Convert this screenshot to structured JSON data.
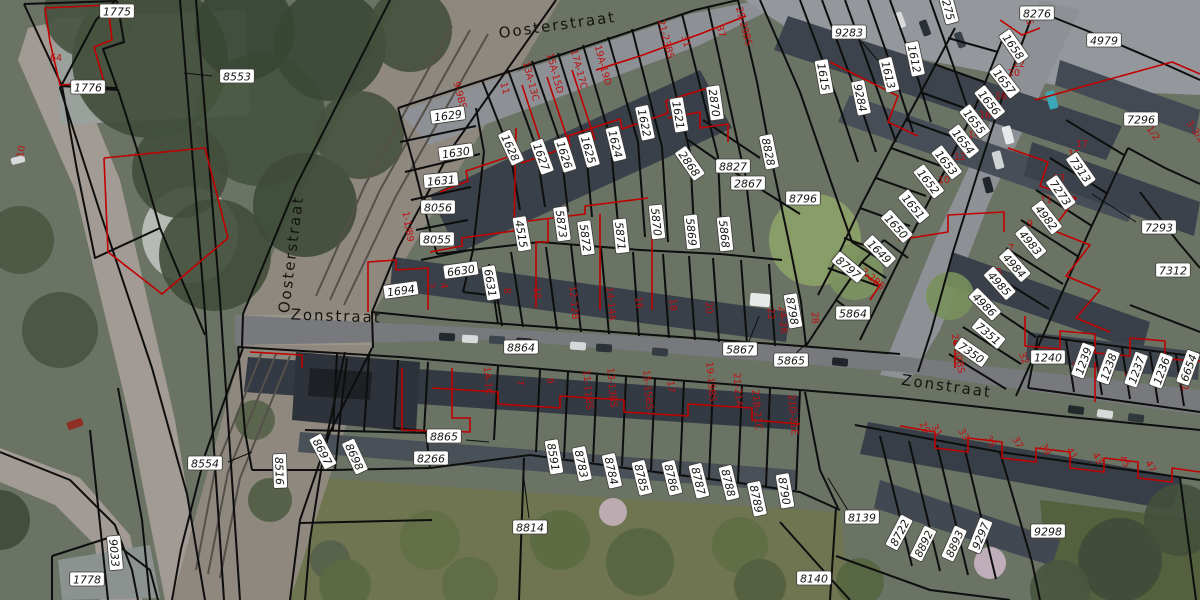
{
  "map": {
    "colors": {
      "parcel_line": "#0e0e0e",
      "building_line": "#c00000",
      "parcel_label_bg": "#ffffff",
      "parcel_label_border": "#3c3c38",
      "parcel_label_text": "#161612",
      "house_number_text": "#c01010",
      "street_text": "#14140f"
    },
    "street_labels": [
      {
        "text": "Oosterstraat",
        "x": 558,
        "y": 30,
        "rot": -8
      },
      {
        "text": "Oosterstraat",
        "x": 296,
        "y": 255,
        "rot": -83
      },
      {
        "text": "Zonstraat",
        "x": 336,
        "y": 321,
        "rot": 2
      },
      {
        "text": "Zonstraat",
        "x": 946,
        "y": 391,
        "rot": 8
      }
    ],
    "parcel_labels": [
      {
        "text": "1775",
        "x": 117,
        "y": 12,
        "rot": 0
      },
      {
        "text": "1776",
        "x": 88,
        "y": 88,
        "rot": 0
      },
      {
        "text": "8553",
        "x": 237,
        "y": 77,
        "rot": 0
      },
      {
        "text": "1629",
        "x": 448,
        "y": 116,
        "rot": -8
      },
      {
        "text": "1630",
        "x": 456,
        "y": 153,
        "rot": -8
      },
      {
        "text": "1631",
        "x": 441,
        "y": 181,
        "rot": -5
      },
      {
        "text": "8056",
        "x": 438,
        "y": 208,
        "rot": 0
      },
      {
        "text": "8055",
        "x": 437,
        "y": 240,
        "rot": 0
      },
      {
        "text": "6630",
        "x": 461,
        "y": 271,
        "rot": -8
      },
      {
        "text": "1694",
        "x": 401,
        "y": 291,
        "rot": -8
      },
      {
        "text": "6631",
        "x": 490,
        "y": 283,
        "rot": 80
      },
      {
        "text": "4515",
        "x": 521,
        "y": 234,
        "rot": 80
      },
      {
        "text": "5873",
        "x": 561,
        "y": 224,
        "rot": 82
      },
      {
        "text": "5872",
        "x": 585,
        "y": 238,
        "rot": 82
      },
      {
        "text": "5871",
        "x": 620,
        "y": 236,
        "rot": 84
      },
      {
        "text": "5870",
        "x": 656,
        "y": 222,
        "rot": 84
      },
      {
        "text": "5869",
        "x": 691,
        "y": 232,
        "rot": 84
      },
      {
        "text": "5868",
        "x": 724,
        "y": 234,
        "rot": 84
      },
      {
        "text": "1628",
        "x": 510,
        "y": 148,
        "rot": 65
      },
      {
        "text": "1627",
        "x": 541,
        "y": 157,
        "rot": 70
      },
      {
        "text": "1626",
        "x": 564,
        "y": 155,
        "rot": 72
      },
      {
        "text": "1625",
        "x": 588,
        "y": 150,
        "rot": 74
      },
      {
        "text": "1624",
        "x": 615,
        "y": 144,
        "rot": 76
      },
      {
        "text": "1622",
        "x": 644,
        "y": 123,
        "rot": 78
      },
      {
        "text": "1621",
        "x": 678,
        "y": 115,
        "rot": 80
      },
      {
        "text": "2870",
        "x": 714,
        "y": 103,
        "rot": 82
      },
      {
        "text": "2868",
        "x": 689,
        "y": 164,
        "rot": 55
      },
      {
        "text": "8827",
        "x": 733,
        "y": 167,
        "rot": 0
      },
      {
        "text": "2867",
        "x": 748,
        "y": 184,
        "rot": 0
      },
      {
        "text": "8828",
        "x": 768,
        "y": 152,
        "rot": 78
      },
      {
        "text": "8796",
        "x": 803,
        "y": 199,
        "rot": 0
      },
      {
        "text": "1658",
        "x": 1013,
        "y": 47,
        "rot": 55
      },
      {
        "text": "1657",
        "x": 1004,
        "y": 82,
        "rot": 52
      },
      {
        "text": "1656",
        "x": 989,
        "y": 103,
        "rot": 52
      },
      {
        "text": "1655",
        "x": 974,
        "y": 122,
        "rot": 52
      },
      {
        "text": "1654",
        "x": 963,
        "y": 142,
        "rot": 52
      },
      {
        "text": "1653",
        "x": 946,
        "y": 163,
        "rot": 52
      },
      {
        "text": "1652",
        "x": 928,
        "y": 182,
        "rot": 52
      },
      {
        "text": "1651",
        "x": 913,
        "y": 207,
        "rot": 50
      },
      {
        "text": "1650",
        "x": 896,
        "y": 227,
        "rot": 48
      },
      {
        "text": "1649",
        "x": 879,
        "y": 252,
        "rot": 45
      },
      {
        "text": "8797",
        "x": 848,
        "y": 268,
        "rot": 40
      },
      {
        "text": "8798",
        "x": 792,
        "y": 311,
        "rot": 80
      },
      {
        "text": "5864",
        "x": 853,
        "y": 314,
        "rot": 0
      },
      {
        "text": "5867",
        "x": 740,
        "y": 350,
        "rot": 0
      },
      {
        "text": "5865",
        "x": 791,
        "y": 361,
        "rot": 0
      },
      {
        "text": "9283",
        "x": 849,
        "y": 33,
        "rot": 0
      },
      {
        "text": "1612",
        "x": 914,
        "y": 59,
        "rot": 78
      },
      {
        "text": "1613",
        "x": 888,
        "y": 75,
        "rot": 76
      },
      {
        "text": "1615",
        "x": 823,
        "y": 77,
        "rot": 80
      },
      {
        "text": "9284",
        "x": 860,
        "y": 98,
        "rot": 78
      },
      {
        "text": "275",
        "x": 948,
        "y": 10,
        "rot": 75
      },
      {
        "text": "8276",
        "x": 1037,
        "y": 14,
        "rot": 0
      },
      {
        "text": "4979",
        "x": 1104,
        "y": 41,
        "rot": 0
      },
      {
        "text": "7296",
        "x": 1141,
        "y": 120,
        "rot": 0
      },
      {
        "text": "7313",
        "x": 1080,
        "y": 170,
        "rot": 55
      },
      {
        "text": "7273",
        "x": 1060,
        "y": 193,
        "rot": 55
      },
      {
        "text": "4982",
        "x": 1046,
        "y": 218,
        "rot": 52
      },
      {
        "text": "4983",
        "x": 1030,
        "y": 243,
        "rot": 50
      },
      {
        "text": "4984",
        "x": 1014,
        "y": 266,
        "rot": 48
      },
      {
        "text": "4985",
        "x": 999,
        "y": 284,
        "rot": 48
      },
      {
        "text": "4986",
        "x": 984,
        "y": 305,
        "rot": 45
      },
      {
        "text": "7351",
        "x": 988,
        "y": 334,
        "rot": 40
      },
      {
        "text": "7350",
        "x": 971,
        "y": 353,
        "rot": 35
      },
      {
        "text": "7293",
        "x": 1159,
        "y": 228,
        "rot": 0
      },
      {
        "text": "7312",
        "x": 1173,
        "y": 271,
        "rot": 0
      },
      {
        "text": "1240",
        "x": 1048,
        "y": 358,
        "rot": 0
      },
      {
        "text": "1239",
        "x": 1084,
        "y": 361,
        "rot": -70
      },
      {
        "text": "1238",
        "x": 1109,
        "y": 367,
        "rot": -70
      },
      {
        "text": "1237",
        "x": 1137,
        "y": 370,
        "rot": -70
      },
      {
        "text": "1236",
        "x": 1162,
        "y": 371,
        "rot": -70
      },
      {
        "text": "6654",
        "x": 1189,
        "y": 368,
        "rot": -70
      },
      {
        "text": "8864",
        "x": 521,
        "y": 348,
        "rot": 0
      },
      {
        "text": "8865",
        "x": 444,
        "y": 437,
        "rot": 0
      },
      {
        "text": "8266",
        "x": 431,
        "y": 459,
        "rot": 0
      },
      {
        "text": "8814",
        "x": 530,
        "y": 528,
        "rot": 0
      },
      {
        "text": "8591",
        "x": 553,
        "y": 457,
        "rot": 80
      },
      {
        "text": "8783",
        "x": 581,
        "y": 464,
        "rot": 78
      },
      {
        "text": "8784",
        "x": 611,
        "y": 471,
        "rot": 77
      },
      {
        "text": "8785",
        "x": 641,
        "y": 478,
        "rot": 76
      },
      {
        "text": "8786",
        "x": 671,
        "y": 478,
        "rot": 76
      },
      {
        "text": "8787",
        "x": 698,
        "y": 481,
        "rot": 76
      },
      {
        "text": "8788",
        "x": 728,
        "y": 483,
        "rot": 76
      },
      {
        "text": "8789",
        "x": 756,
        "y": 499,
        "rot": 78
      },
      {
        "text": "8790",
        "x": 784,
        "y": 491,
        "rot": 80
      },
      {
        "text": "8554",
        "x": 205,
        "y": 464,
        "rot": 0
      },
      {
        "text": "8516",
        "x": 279,
        "y": 471,
        "rot": 88
      },
      {
        "text": "8697",
        "x": 322,
        "y": 452,
        "rot": 62
      },
      {
        "text": "8698",
        "x": 354,
        "y": 457,
        "rot": 65
      },
      {
        "text": "9033",
        "x": 114,
        "y": 553,
        "rot": 85
      },
      {
        "text": "1778",
        "x": 87,
        "y": 580,
        "rot": 0
      },
      {
        "text": "8139",
        "x": 862,
        "y": 518,
        "rot": 0
      },
      {
        "text": "8140",
        "x": 814,
        "y": 579,
        "rot": 0
      },
      {
        "text": "8722",
        "x": 900,
        "y": 533,
        "rot": -62
      },
      {
        "text": "8892",
        "x": 924,
        "y": 544,
        "rot": -64
      },
      {
        "text": "8893",
        "x": 955,
        "y": 544,
        "rot": -66
      },
      {
        "text": "9297",
        "x": 981,
        "y": 536,
        "rot": -68
      },
      {
        "text": "9298",
        "x": 1048,
        "y": 532,
        "rot": 0
      }
    ],
    "house_number_labels": [
      {
        "text": "9-9BS",
        "x": 457,
        "y": 96,
        "rot": 75
      },
      {
        "text": "11",
        "x": 502,
        "y": 89,
        "rot": 75
      },
      {
        "text": "13A-13C",
        "x": 528,
        "y": 82,
        "rot": 75
      },
      {
        "text": "15A-15D",
        "x": 552,
        "y": 74,
        "rot": 75
      },
      {
        "text": "17A-17C",
        "x": 576,
        "y": 70,
        "rot": 75
      },
      {
        "text": "19A-19D",
        "x": 600,
        "y": 66,
        "rot": 75
      },
      {
        "text": "21-23BS",
        "x": 663,
        "y": 40,
        "rot": 75
      },
      {
        "text": "31",
        "x": 683,
        "y": 42,
        "rot": 75
      },
      {
        "text": "37",
        "x": 718,
        "y": 32,
        "rot": 75
      },
      {
        "text": "29-29BS",
        "x": 741,
        "y": 27,
        "rot": 75
      },
      {
        "text": "45",
        "x": 1026,
        "y": 20,
        "rot": 75
      },
      {
        "text": "22",
        "x": 1019,
        "y": 67,
        "rot": 0
      },
      {
        "text": "20",
        "x": 1014,
        "y": 76,
        "rot": 0
      },
      {
        "text": "18",
        "x": 1001,
        "y": 99,
        "rot": 0
      },
      {
        "text": "16",
        "x": 985,
        "y": 118,
        "rot": 0
      },
      {
        "text": "14",
        "x": 974,
        "y": 138,
        "rot": 0
      },
      {
        "text": "12",
        "x": 960,
        "y": 160,
        "rot": 0
      },
      {
        "text": "10",
        "x": 944,
        "y": 183,
        "rot": 0
      },
      {
        "text": "17",
        "x": 1082,
        "y": 147,
        "rot": 0
      },
      {
        "text": "15",
        "x": 1074,
        "y": 157,
        "rot": 0
      },
      {
        "text": "13",
        "x": 1059,
        "y": 181,
        "rot": 0
      },
      {
        "text": "11",
        "x": 1046,
        "y": 203,
        "rot": 0
      },
      {
        "text": "9",
        "x": 1030,
        "y": 227,
        "rot": 0
      },
      {
        "text": "7",
        "x": 1011,
        "y": 251,
        "rot": 0
      },
      {
        "text": "5",
        "x": 999,
        "y": 275,
        "rot": 0
      },
      {
        "text": "1-1/2",
        "x": 1148,
        "y": 131,
        "rot": 55
      },
      {
        "text": "3-3/2",
        "x": 1193,
        "y": 133,
        "rot": 55
      },
      {
        "text": "2-2BS",
        "x": 871,
        "y": 281,
        "rot": 40
      },
      {
        "text": "1-1/89",
        "x": 405,
        "y": 227,
        "rot": 80
      },
      {
        "text": "2",
        "x": 428,
        "y": 286,
        "rot": 85
      },
      {
        "text": "4",
        "x": 441,
        "y": 286,
        "rot": 85
      },
      {
        "text": "8",
        "x": 504,
        "y": 291,
        "rot": 85
      },
      {
        "text": "10",
        "x": 534,
        "y": 293,
        "rot": 85
      },
      {
        "text": "12-12B",
        "x": 571,
        "y": 303,
        "rot": 85
      },
      {
        "text": "14-14A",
        "x": 608,
        "y": 304,
        "rot": 85
      },
      {
        "text": "16",
        "x": 636,
        "y": 303,
        "rot": 85
      },
      {
        "text": "18",
        "x": 670,
        "y": 305,
        "rot": 85
      },
      {
        "text": "20",
        "x": 706,
        "y": 308,
        "rot": 85
      },
      {
        "text": "22",
        "x": 768,
        "y": 314,
        "rot": 85
      },
      {
        "text": "24-26",
        "x": 780,
        "y": 320,
        "rot": 85
      },
      {
        "text": "28",
        "x": 812,
        "y": 318,
        "rot": 85
      },
      {
        "text": "26-30BS",
        "x": 955,
        "y": 354,
        "rot": 80
      },
      {
        "text": "1A-1C",
        "x": 485,
        "y": 381,
        "rot": 85
      },
      {
        "text": "7",
        "x": 517,
        "y": 383,
        "rot": 85
      },
      {
        "text": "9",
        "x": 547,
        "y": 381,
        "rot": 85
      },
      {
        "text": "11-11BS",
        "x": 585,
        "y": 390,
        "rot": 85
      },
      {
        "text": "13-13BS",
        "x": 609,
        "y": 388,
        "rot": 85
      },
      {
        "text": "15-15BS",
        "x": 645,
        "y": 390,
        "rot": 85
      },
      {
        "text": "17",
        "x": 668,
        "y": 387,
        "rot": 85
      },
      {
        "text": "19-19BS",
        "x": 708,
        "y": 382,
        "rot": 85
      },
      {
        "text": "21-21A",
        "x": 735,
        "y": 390,
        "rot": 85
      },
      {
        "text": "21B-21C",
        "x": 754,
        "y": 410,
        "rot": 85
      },
      {
        "text": "21D-21E",
        "x": 790,
        "y": 415,
        "rot": 85
      },
      {
        "text": "29",
        "x": 922,
        "y": 429,
        "rot": 60
      },
      {
        "text": "31",
        "x": 934,
        "y": 432,
        "rot": 60
      },
      {
        "text": "33",
        "x": 961,
        "y": 436,
        "rot": 60
      },
      {
        "text": "35",
        "x": 988,
        "y": 443,
        "rot": 60
      },
      {
        "text": "37",
        "x": 1015,
        "y": 444,
        "rot": 60
      },
      {
        "text": "39",
        "x": 1043,
        "y": 451,
        "rot": 60
      },
      {
        "text": "41",
        "x": 1069,
        "y": 455,
        "rot": 60
      },
      {
        "text": "43",
        "x": 1095,
        "y": 460,
        "rot": 60
      },
      {
        "text": "45",
        "x": 1122,
        "y": 463,
        "rot": 60
      },
      {
        "text": "47",
        "x": 1148,
        "y": 468,
        "rot": 60
      },
      {
        "text": "32",
        "x": 1021,
        "y": 359,
        "rot": 70
      },
      {
        "text": "34",
        "x": 1074,
        "y": 367,
        "rot": 70
      },
      {
        "text": "36",
        "x": 1099,
        "y": 372,
        "rot": 70
      },
      {
        "text": "38",
        "x": 1126,
        "y": 377,
        "rot": 70
      },
      {
        "text": "40",
        "x": 1153,
        "y": 380,
        "rot": 70
      },
      {
        "text": "42",
        "x": 1181,
        "y": 386,
        "rot": 70
      },
      {
        "text": "64",
        "x": 56,
        "y": 61,
        "rot": 0
      },
      {
        "text": "10",
        "x": 24,
        "y": 152,
        "rot": -80
      }
    ]
  }
}
